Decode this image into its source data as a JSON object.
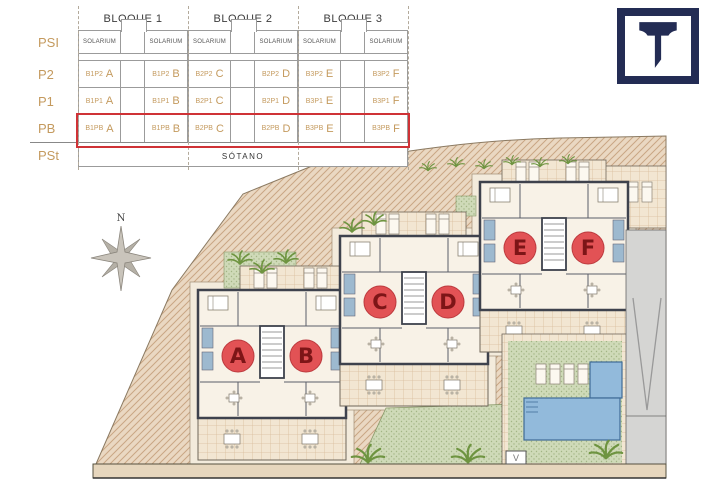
{
  "table": {
    "row_labels": [
      "PSI",
      "P2",
      "P1",
      "PB",
      "PSt"
    ],
    "sotano": "SÓTANO",
    "bloques": [
      {
        "name": "BLOQUE 1",
        "solarium": [
          "SOLARIUM",
          "SOLARIUM"
        ],
        "rows": [
          {
            "lcode": "B1P2",
            "lletter": "A",
            "rcode": "B1P2",
            "rletter": "B"
          },
          {
            "lcode": "B1P1",
            "lletter": "A",
            "rcode": "B1P1",
            "rletter": "B"
          },
          {
            "lcode": "B1PB",
            "lletter": "A",
            "rcode": "B1PB",
            "rletter": "B"
          }
        ]
      },
      {
        "name": "BLOQUE 2",
        "solarium": [
          "SOLARIUM",
          "SOLARIUM"
        ],
        "rows": [
          {
            "lcode": "B2P2",
            "lletter": "C",
            "rcode": "B2P2",
            "rletter": "D"
          },
          {
            "lcode": "B2P1",
            "lletter": "C",
            "rcode": "B2P1",
            "rletter": "D"
          },
          {
            "lcode": "B2PB",
            "lletter": "C",
            "rcode": "B2PB",
            "rletter": "D"
          }
        ]
      },
      {
        "name": "BLOQUE 3",
        "solarium": [
          "SOLARIUM",
          "SOLARIUM"
        ],
        "rows": [
          {
            "lcode": "B3P2",
            "lletter": "E",
            "rcode": "B3P2",
            "rletter": "F"
          },
          {
            "lcode": "B3P1",
            "lletter": "E",
            "rcode": "B3P1",
            "rletter": "F"
          },
          {
            "lcode": "B3PB",
            "lletter": "E",
            "rcode": "B3PB",
            "rletter": "F"
          }
        ]
      }
    ],
    "highlighted_row": "PB"
  },
  "logo": {
    "letter": "T"
  },
  "plan": {
    "north": "N",
    "apartments": [
      {
        "label": "A"
      },
      {
        "label": "B"
      },
      {
        "label": "C"
      },
      {
        "label": "D"
      },
      {
        "label": "E"
      },
      {
        "label": "F"
      }
    ],
    "gate_marker": "V"
  },
  "colors": {
    "accent_red": "#cf3236",
    "gold": "#c49a5e",
    "navy": "#232c54",
    "marker_red": "#e25255",
    "pool_blue": "#92badb",
    "terrain_tan": "#ead8c2"
  }
}
